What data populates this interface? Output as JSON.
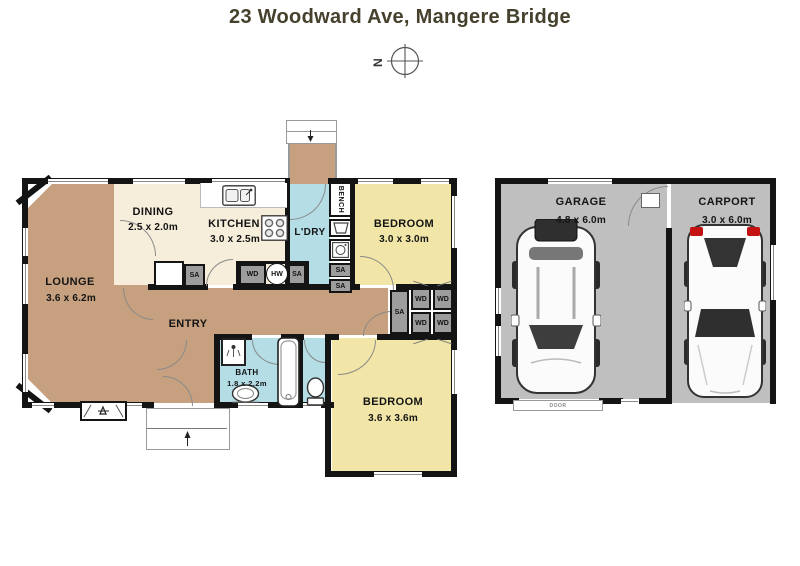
{
  "title": "23 Woodward Ave, Mangere Bridge",
  "compass": {
    "north_letter": "N"
  },
  "rooms": {
    "lounge": {
      "name": "LOUNGE",
      "dims": "3.6 x 6.2m"
    },
    "dining": {
      "name": "DINING",
      "dims": "2.5 x 2.0m"
    },
    "kitchen": {
      "name": "KITCHEN",
      "dims": "3.0 x 2.5m"
    },
    "laundry": {
      "name": "L'DRY"
    },
    "bedroom1": {
      "name": "BEDROOM",
      "dims": "3.0 x 3.0m"
    },
    "entry": {
      "name": "ENTRY"
    },
    "bath": {
      "name": "BATH",
      "dims": "1.8 x 2.2m"
    },
    "bedroom2": {
      "name": "BEDROOM",
      "dims": "3.6 x 3.6m"
    },
    "garage": {
      "name": "GARAGE",
      "dims": "4.8 x 6.0m"
    },
    "carport": {
      "name": "CARPORT",
      "dims": "3.0 x 6.0m"
    }
  },
  "fixtures": {
    "bench": "BENCH",
    "hw": "HW",
    "wd": "WD",
    "sa": "SA",
    "door": "DOOR"
  },
  "colors": {
    "wall": "#141414",
    "living_areas": "#c7a17f",
    "kitchen_dining": "#f6eedb",
    "bedrooms": "#f1e6a7",
    "wet_areas": "#b4dde6",
    "garage_floor": "#bfbfbf",
    "closets": "#9d9d9d",
    "title_text": "#46412d",
    "taillight_red": "#c41111"
  }
}
